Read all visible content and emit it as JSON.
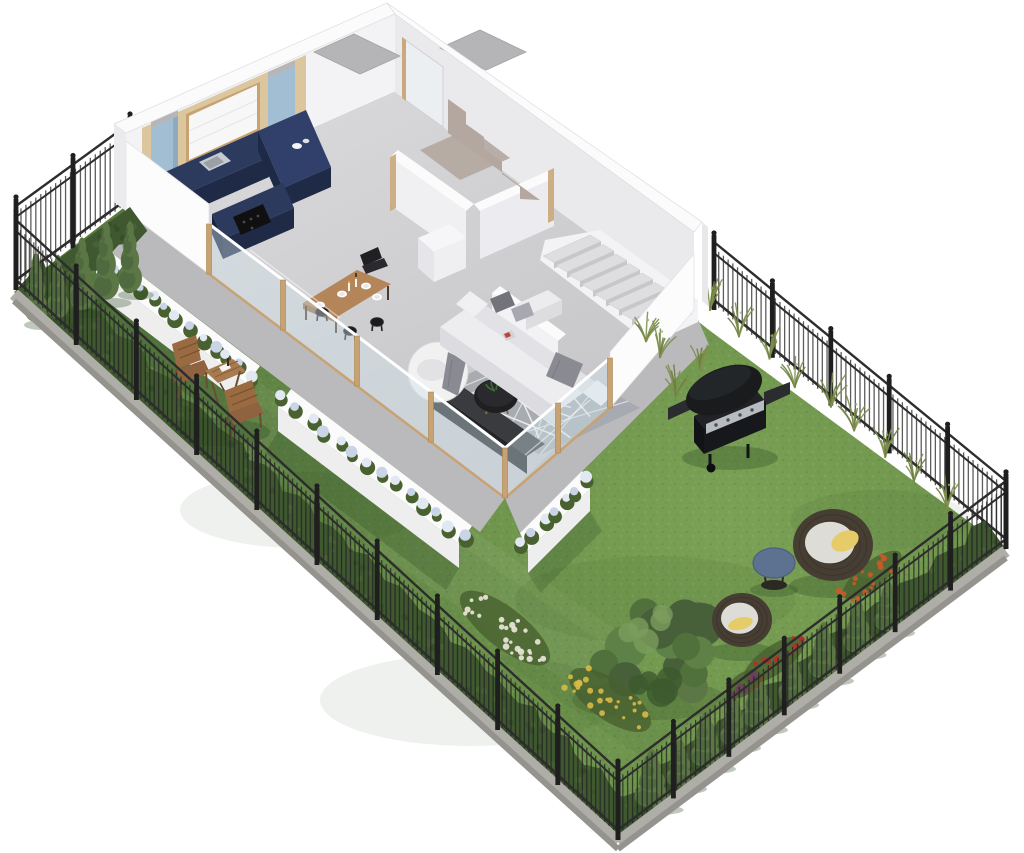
{
  "page": {
    "background": "#ffffff"
  },
  "scene": {
    "kind": "Isometric 3D cutaway floor plan of a ground-floor apartment with a private fenced garden",
    "view": "axonometric bird's-eye render, no text labels"
  },
  "colors": {
    "background": "#ffffff",
    "lawn_light": "#7ba155",
    "lawn_mid": "#6b914b",
    "lawn_dark": "#55793c",
    "hedge": "#3f5830",
    "hedge_dark": "#33482a",
    "conifer": "#5c7745",
    "conifer_dark": "#47603a",
    "grass_tuft": "#7e8f4e",
    "fence": "#1f1f1f",
    "fence_rail": "#2d2d2d",
    "curb": "#aeada7",
    "curb_face": "#94938d",
    "wall_top": "#fbfbfc",
    "wall_face_left": "#f3f3f5",
    "wall_face_right": "#eaeaed",
    "wall_taupe": "#b3a79f",
    "floor_a": "#d9d9db",
    "floor_b": "#c7c7ca",
    "terrace": "#bababc",
    "stair_tread": "#dedee1",
    "stair_riser": "#c7c7ca",
    "kitchen_navy": "#2c3a5e",
    "kitchen_navy_dark": "#1f2a47",
    "kitchen_navy_top": "#30406a",
    "cabinet_blue": "#a2bed2",
    "cabinet_blue_dark": "#8cabc2",
    "wood_panel": "#dcc69e",
    "wood_frame": "#c8a272",
    "blind": "#f7f7f8",
    "steel": "#c6cbd0",
    "cooktop": "#101010",
    "table_wood": "#b5855a",
    "table_wood_dark": "#9a6c44",
    "stool_black": "#1b1b1d",
    "sofa": "#ededf0",
    "sofa_shade": "#e2e2e6",
    "sofa_front": "#dcdce0",
    "pillow_gray": "#73737b",
    "pillow_light": "#a8a8b0",
    "throw_gray": "#8a8a92",
    "rug": "#a7abb0",
    "rug_line": "#f2f3f4",
    "coffee_table": "#1f1f22",
    "console_top": "#393b3f",
    "console_front": "#232528",
    "ball_chair": "#f1f1f2",
    "glass": "#cfe2ea",
    "planter_face": "#eeeeef",
    "hydrangea": "#c9d4e6",
    "hydrangea_light": "#e2e8f1",
    "leaf": "#49602f",
    "chair_wood": "#9a6a41",
    "chair_wood_dark": "#7c5331",
    "bbq_body": "#1a1b1d",
    "bbq_steel": "#b7bcc1",
    "rattan": "#463d33",
    "rattan_dark": "#332c24",
    "cushion_white": "#dddcd6",
    "cushion_yellow": "#e5cc68",
    "side_table_blue": "#5d7191",
    "flower_white": "#ece9da",
    "flower_yellow": "#d9b945",
    "flower_red": "#b23226",
    "flower_purple": "#6f3d5f",
    "flower_orange": "#cc5a28",
    "shadow": "#2c4a22"
  },
  "inventory": {
    "interior": [
      "navy L-shaped kitchen with steel sink and black cooktop",
      "light-blue wall cabinets flanking a window with white roller blind",
      "light oak wall panelling",
      "wooden dining table with four place settings and candles",
      "black round stools and dark dining chair",
      "white sofa with gray cushions and throw",
      "round white lounge chair",
      "black round coffee table with plant",
      "dark media sideboard",
      "gray rug with white geometric lines",
      "concrete staircase along rear wall",
      "taupe stairwell wall",
      "entry closets and WC partition walls"
    ],
    "exterior": [
      "fenced lawn with black ornamental iron fence on concrete curb",
      "boxwood hedges along fences",
      "cypress trees in northwest and southeast corners",
      "white planter walls with blue hydrangeas",
      "glass balustrade with oak posts on terrace",
      "two wooden folding chairs with bistro table",
      "black gas barbecue grill",
      "two rattan cocoon chairs with yellow cushions",
      "round blue side table",
      "white, yellow, red and purple flowering shrubs",
      "ornamental grasses along east fence",
      "leafy garden tree"
    ]
  }
}
